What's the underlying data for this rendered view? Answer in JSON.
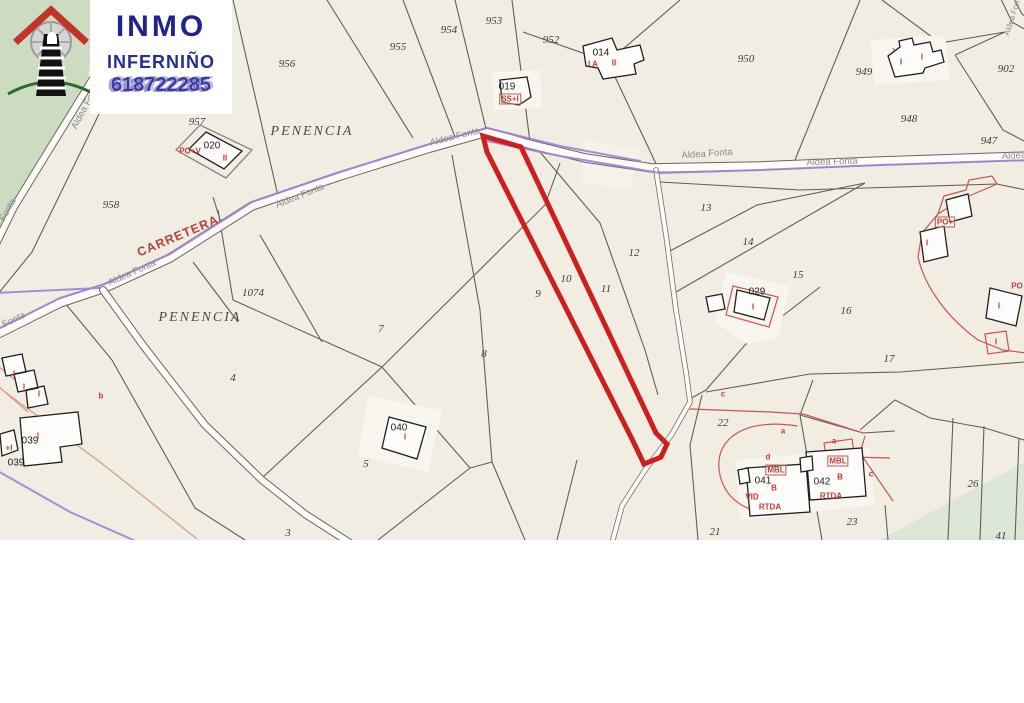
{
  "logo": {
    "line1": "INMO",
    "line2": "INFERNIÑO",
    "phone": "618722285"
  },
  "map": {
    "colors": {
      "background": "#f1ede3",
      "boundary_line": "#55524c",
      "road_purple": "#9c83d1",
      "highlight_red": "#cd1f1f",
      "cadastre_red": "#c4564e",
      "green_zone_topleft": "#cbdcc0",
      "green_zone_bottomright": "#dce6d6",
      "road_label_gray": "#8b8b89"
    },
    "place_labels": [
      {
        "t": "PENENCIA",
        "x": 312,
        "y": 132,
        "r": 0
      },
      {
        "t": "PENENCIA",
        "x": 200,
        "y": 318,
        "r": 0
      }
    ],
    "special_labels": [
      {
        "t": "CARRETERA",
        "x": 178,
        "y": 236,
        "r": -23
      }
    ],
    "road_labels": [
      {
        "t": "Aldea Fonta",
        "x": 132,
        "y": 273,
        "r": -24
      },
      {
        "t": "Aldea Fonta",
        "x": 300,
        "y": 196,
        "r": -22
      },
      {
        "t": "Aldea Fonta",
        "x": 455,
        "y": 137,
        "r": -14
      },
      {
        "t": "Aldea Fonta",
        "x": 707,
        "y": 154,
        "r": -4
      },
      {
        "t": "Aldea Fonta",
        "x": 832,
        "y": 162,
        "r": -2
      },
      {
        "t": "Aldea",
        "x": 1014,
        "y": 156,
        "r": -2
      },
      {
        "t": "Aldea Fonta",
        "x": 86,
        "y": 106,
        "r": -62
      },
      {
        "t": "Fonta",
        "x": 8,
        "y": 210,
        "r": -60
      },
      {
        "t": "Fonta",
        "x": 14,
        "y": 320,
        "r": -26
      },
      {
        "t": "Aldea Fon",
        "x": 1012,
        "y": 18,
        "r": -72,
        "fs": 8
      }
    ],
    "parcel_numbers": [
      {
        "t": "956",
        "x": 287,
        "y": 64
      },
      {
        "t": "955",
        "x": 398,
        "y": 47
      },
      {
        "t": "954",
        "x": 449,
        "y": 30
      },
      {
        "t": "953",
        "x": 494,
        "y": 21
      },
      {
        "t": "952",
        "x": 551,
        "y": 40
      },
      {
        "t": "950",
        "x": 746,
        "y": 59
      },
      {
        "t": "949",
        "x": 864,
        "y": 72
      },
      {
        "t": "948",
        "x": 909,
        "y": 119
      },
      {
        "t": "947",
        "x": 989,
        "y": 141
      },
      {
        "t": "902",
        "x": 1006,
        "y": 69
      },
      {
        "t": "957",
        "x": 197,
        "y": 122
      },
      {
        "t": "958",
        "x": 111,
        "y": 205
      },
      {
        "t": "1074",
        "x": 253,
        "y": 293
      },
      {
        "t": "13",
        "x": 706,
        "y": 208
      },
      {
        "t": "12",
        "x": 634,
        "y": 253
      },
      {
        "t": "14",
        "x": 748,
        "y": 242
      },
      {
        "t": "15",
        "x": 798,
        "y": 275
      },
      {
        "t": "16",
        "x": 846,
        "y": 311
      },
      {
        "t": "17",
        "x": 889,
        "y": 359
      },
      {
        "t": "10",
        "x": 566,
        "y": 279
      },
      {
        "t": "9",
        "x": 538,
        "y": 294
      },
      {
        "t": "11",
        "x": 606,
        "y": 289
      },
      {
        "t": "7",
        "x": 381,
        "y": 329
      },
      {
        "t": "8",
        "x": 484,
        "y": 354
      },
      {
        "t": "4",
        "x": 233,
        "y": 378
      },
      {
        "t": "5",
        "x": 366,
        "y": 464
      },
      {
        "t": "3",
        "x": 288,
        "y": 533
      },
      {
        "t": "22",
        "x": 723,
        "y": 423
      },
      {
        "t": "21",
        "x": 715,
        "y": 532
      },
      {
        "t": "23",
        "x": 852,
        "y": 522
      },
      {
        "t": "26",
        "x": 973,
        "y": 484
      },
      {
        "t": "41",
        "x": 1001,
        "y": 536
      }
    ],
    "building_labels": [
      {
        "t": "014",
        "x": 601,
        "y": 53
      },
      {
        "t": "019",
        "x": 507,
        "y": 87
      },
      {
        "t": "020",
        "x": 212,
        "y": 146
      },
      {
        "t": "029",
        "x": 757,
        "y": 292
      },
      {
        "t": "040",
        "x": 399,
        "y": 428
      },
      {
        "t": "041",
        "x": 763,
        "y": 481
      },
      {
        "t": "042",
        "x": 822,
        "y": 482
      },
      {
        "t": "039",
        "x": 30,
        "y": 441
      },
      {
        "t": "039",
        "x": 16,
        "y": 463
      }
    ],
    "red_annotations": [
      {
        "t": "SS+I",
        "x": 510,
        "y": 99,
        "box": true
      },
      {
        "t": "I A",
        "x": 593,
        "y": 64
      },
      {
        "t": "II",
        "x": 614,
        "y": 63
      },
      {
        "t": "PO+V",
        "x": 190,
        "y": 151
      },
      {
        "t": "II",
        "x": 225,
        "y": 158
      },
      {
        "t": "I",
        "x": 753,
        "y": 307
      },
      {
        "t": "I",
        "x": 405,
        "y": 437
      },
      {
        "t": "I",
        "x": 901,
        "y": 62
      },
      {
        "t": "I",
        "x": 922,
        "y": 57
      },
      {
        "t": "PO+",
        "x": 945,
        "y": 222,
        "box": true
      },
      {
        "t": "I",
        "x": 927,
        "y": 243
      },
      {
        "t": "PO",
        "x": 1017,
        "y": 286
      },
      {
        "t": "I",
        "x": 999,
        "y": 306
      },
      {
        "t": "I",
        "x": 996,
        "y": 342
      },
      {
        "t": "MBL",
        "x": 776,
        "y": 470,
        "box": true
      },
      {
        "t": "MBL",
        "x": 838,
        "y": 461,
        "box": true
      },
      {
        "t": "B",
        "x": 774,
        "y": 488
      },
      {
        "t": "B",
        "x": 840,
        "y": 477
      },
      {
        "t": "RTDA",
        "x": 770,
        "y": 507
      },
      {
        "t": "RTDA",
        "x": 831,
        "y": 496
      },
      {
        "t": "VID",
        "x": 752,
        "y": 497
      },
      {
        "t": "c",
        "x": 723,
        "y": 394
      },
      {
        "t": "a",
        "x": 783,
        "y": 431
      },
      {
        "t": "a",
        "x": 834,
        "y": 441
      },
      {
        "t": "d",
        "x": 768,
        "y": 457
      },
      {
        "t": "c",
        "x": 871,
        "y": 474
      },
      {
        "t": "b",
        "x": 101,
        "y": 396
      },
      {
        "t": "I",
        "x": 14,
        "y": 374
      },
      {
        "t": "I",
        "x": 24,
        "y": 387
      },
      {
        "t": "I",
        "x": 39,
        "y": 394
      },
      {
        "t": "I",
        "x": 38,
        "y": 436
      },
      {
        "t": "+I",
        "x": 9,
        "y": 448
      }
    ]
  }
}
